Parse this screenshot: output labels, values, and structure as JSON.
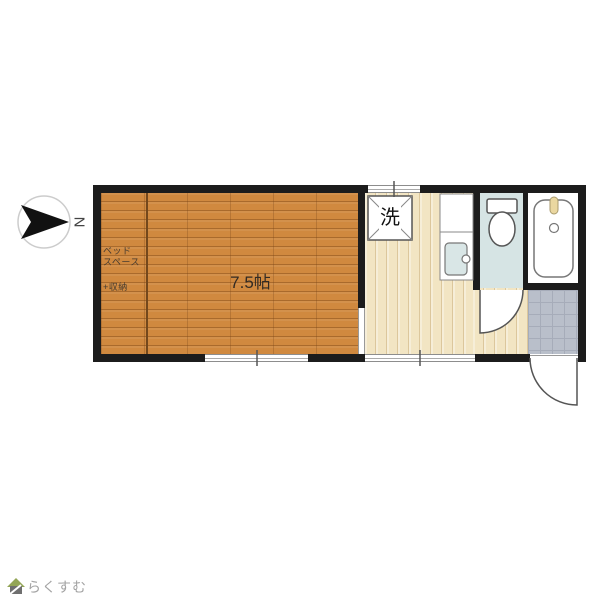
{
  "floor_plan": {
    "room_label": "7.5帖",
    "bed_space": {
      "line1": "ベッド",
      "line2": "スペース",
      "line3": "+収納"
    },
    "washer_label": "洗",
    "compass_letter": "N"
  },
  "footer": {
    "brand": "らくすむ"
  },
  "colors": {
    "wall": "#1c1c1c",
    "wood_floor": "#d0893f",
    "hall_floor": "#f2e5c3",
    "entrance_tile": "#b9bfca",
    "toilet_floor": "#d6e4e4",
    "sink": "#d9e6e6",
    "faucet": "#ead7a0",
    "logo_green": "#93a556",
    "brand_text": "#a3a3a3"
  }
}
